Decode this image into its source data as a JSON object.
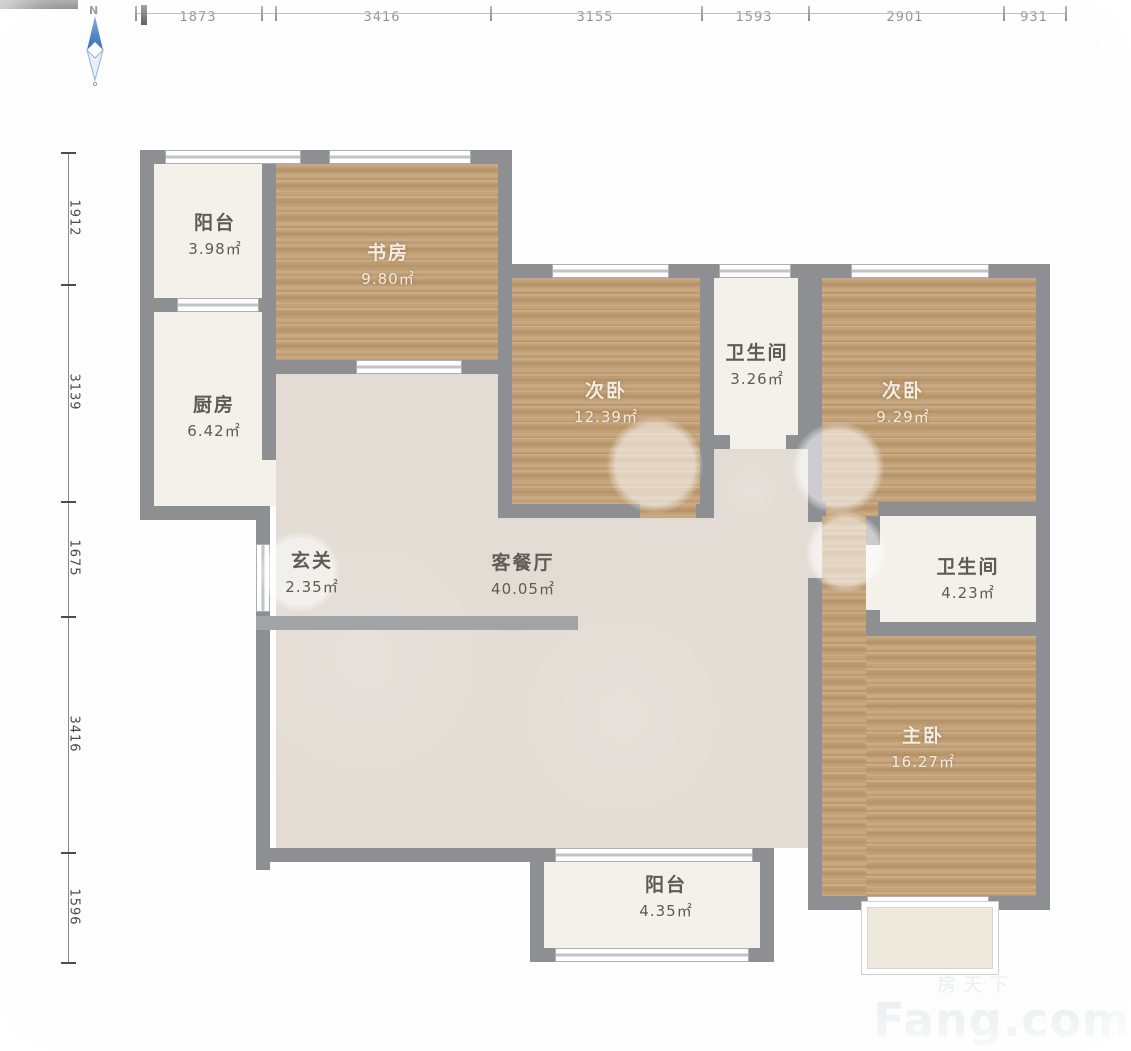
{
  "compass": {
    "north": "N"
  },
  "dims_top": [
    "1873",
    "3416",
    "3155",
    "1593",
    "2901",
    "931"
  ],
  "dims_left": [
    "1912",
    "3139",
    "1675",
    "3416",
    "1596"
  ],
  "rooms": [
    {
      "id": "balcony-top",
      "name": "阳台",
      "area": "3.98㎡"
    },
    {
      "id": "study",
      "name": "书房",
      "area": "9.80㎡"
    },
    {
      "id": "kitchen",
      "name": "厨房",
      "area": "6.42㎡"
    },
    {
      "id": "bedroom-mid",
      "name": "次卧",
      "area": "12.39㎡"
    },
    {
      "id": "bath-1",
      "name": "卫生间",
      "area": "3.26㎡"
    },
    {
      "id": "bedroom-right",
      "name": "次卧",
      "area": "9.29㎡"
    },
    {
      "id": "entry",
      "name": "玄关",
      "area": "2.35㎡"
    },
    {
      "id": "living-dining",
      "name": "客餐厅",
      "area": "40.05㎡"
    },
    {
      "id": "bath-2",
      "name": "卫生间",
      "area": "4.23㎡"
    },
    {
      "id": "master-bedroom",
      "name": "主卧",
      "area": "16.27㎡"
    },
    {
      "id": "balcony-bottom",
      "name": "阳台",
      "area": "4.35㎡"
    }
  ],
  "watermark": {
    "cn": "房天下",
    "en": "Fang.com"
  },
  "colors": {
    "wall": "#8e8f93",
    "wood": "#c2a076",
    "living_floor": "#e2dcd4",
    "tile_floor": "#f4f1ea",
    "north_arrow": "#2e6fb7"
  }
}
